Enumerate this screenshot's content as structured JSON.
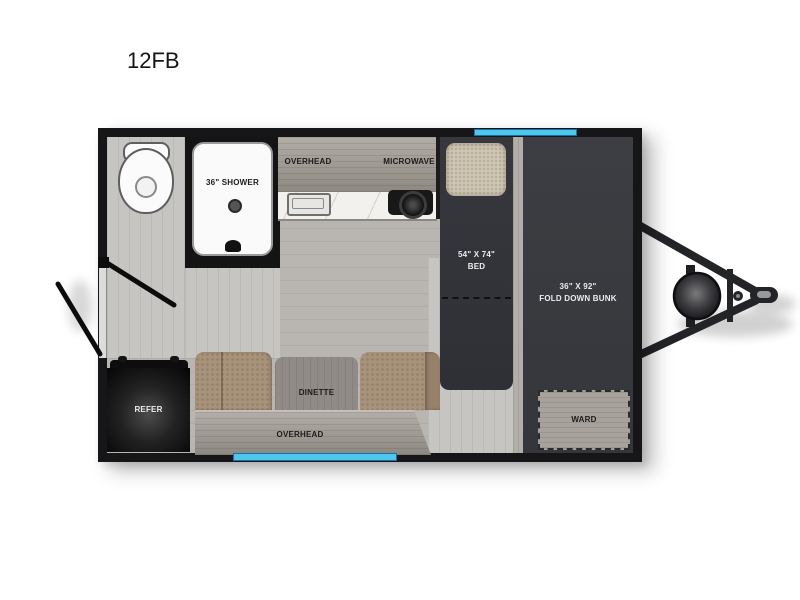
{
  "title": "12FB",
  "labels": {
    "shower": "36\" SHOWER",
    "overhead_top": "OVERHEAD",
    "microwave": "MICROWAVE",
    "bed_size": "54\" X 74\"",
    "bed": "BED",
    "bunk_size": "36\" X 92\"",
    "bunk": "FOLD DOWN BUNK",
    "ward": "WARD",
    "dinette": "DINETTE",
    "overhead_bottom": "OVERHEAD",
    "refer": "REFER"
  },
  "colors": {
    "window_accent": "#4ec7ef",
    "window_border": "#1d6fa3",
    "wall": "#161618",
    "bed_dark": "#34363b",
    "bunk_dark": "#3a3c41",
    "cushion_tan": "#a8937a",
    "pillow_tan": "#cfc6b3",
    "floor_gray": "#b9b6b2",
    "bath_floor_gray": "#c7c5c1"
  },
  "fixtures": [
    "toilet-icon",
    "shower-drain-icon",
    "shower-faucet-icon",
    "sink-icon",
    "cooktop-icon",
    "refrigerator-icon",
    "propane-tank-icon",
    "hitch-coupler-icon",
    "entry-door-swing",
    "bathroom-door-swing",
    "window-top",
    "window-bottom"
  ]
}
